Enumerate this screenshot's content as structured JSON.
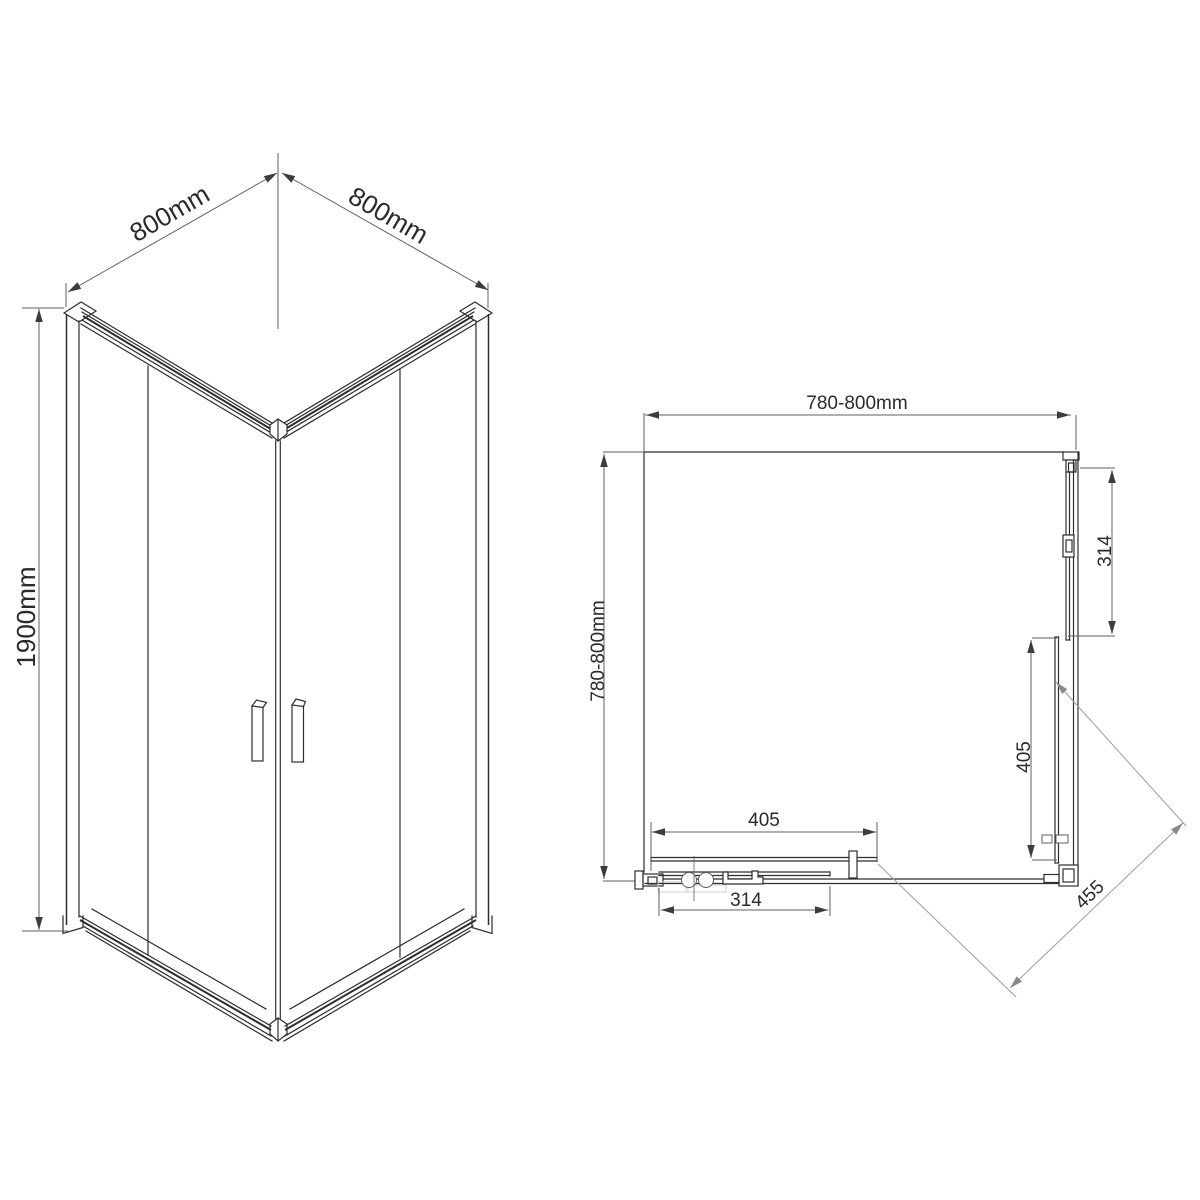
{
  "isometric_view": {
    "dim_width_left": "800mm",
    "dim_width_right": "800mm",
    "dim_height": "1900mm"
  },
  "plan_view": {
    "dim_width_top": "780-800mm",
    "dim_depth_left": "780-800mm",
    "dim_fixed_panel_side": "314",
    "dim_door_side": "405",
    "dim_door_bottom": "405",
    "dim_fixed_panel_bottom": "314",
    "dim_diagonal_entry": "455"
  },
  "colors": {
    "line": "#2e2e2e",
    "dimension": "#5f5f5f",
    "light": "#9c9c9c",
    "ghost": "#cfcfcf",
    "arrow": "#3c3c3c",
    "background": "#ffffff",
    "text": "#2a2a2a"
  }
}
